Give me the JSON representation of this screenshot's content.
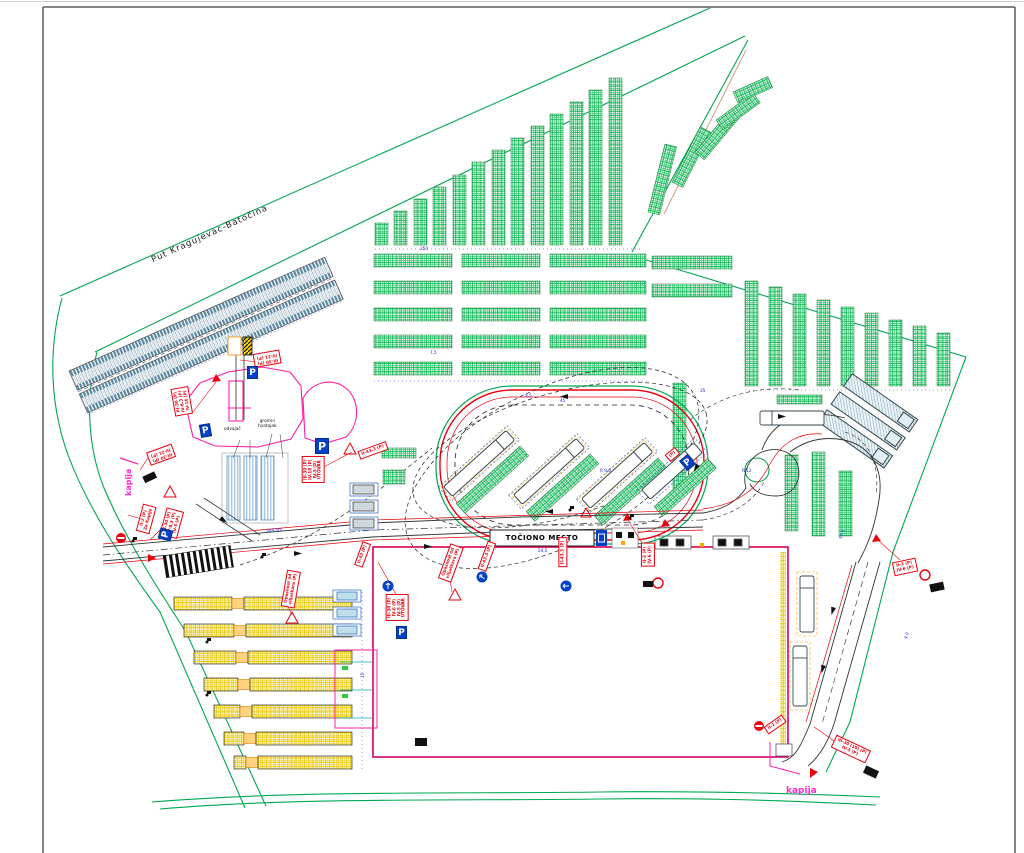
{
  "page": {
    "bg": "#ffffff",
    "frame_color": "#5a5a5a"
  },
  "colors": {
    "site_green": "#00a651",
    "strip_green": "#00b44a",
    "teal": "#5b87a0",
    "yellow": "#e8c400",
    "magenta_building": "#ff1ea5",
    "building_edge": "#d4006a",
    "sign_red": "#e8000d",
    "sign_blue": "#0540c8",
    "dim_blue": "#2222e0",
    "tan": "#c8a07e"
  },
  "labels": {
    "road": "Put Kragujevac-Batočina",
    "fuel": "TOČIONO MESTO",
    "gate_w": "kapija",
    "gate_s": "kapija",
    "sep": "odvajač",
    "trap": "gromni\nhvatajak",
    "p": "P",
    "warn": "!"
  },
  "signs": {
    "a": "III-30 (P)\nIV-8.3 (P)\nIV-16 (P)",
    "b": "III-30 (P)\nIV-21 (P)",
    "c": "II-2 (P)\nZa Kapije",
    "d": "III-30 (P)\nIV-8.3 (P)\nIV-5 (P)",
    "e": "Opasnost od\nviljuškara (P)",
    "f": "III-30 (P)\nIV-21 (P)",
    "g": "III-30 (P)\nIV-18 (P)\nIV-5 (P)\nUTOVAR",
    "h": "II-43 (P)",
    "i": "Opasnost od\nviljuškara (P)",
    "j": "II-43.3 (P)",
    "k": "III-30 (P)\nIV-6 (P)\nIV-5 (P)\nUTOVAR",
    "l": "II-43.3 (P)",
    "m": "II-3 (P)\nIV-6 (P)",
    "n": "II-3 (P)\nIV-6 (P)",
    "o": "II-2 (P)",
    "p": "III-30 (10) (P)\nIV-5 (P)",
    "q": "(P)",
    "r": "II-43.3 (P)"
  },
  "dims": [
    "4,5",
    "45",
    "R 9,0",
    "5x4,5m",
    "7,5",
    "35",
    "57,5",
    "24,5",
    "250",
    "R 12",
    "4,0",
    "15"
  ]
}
